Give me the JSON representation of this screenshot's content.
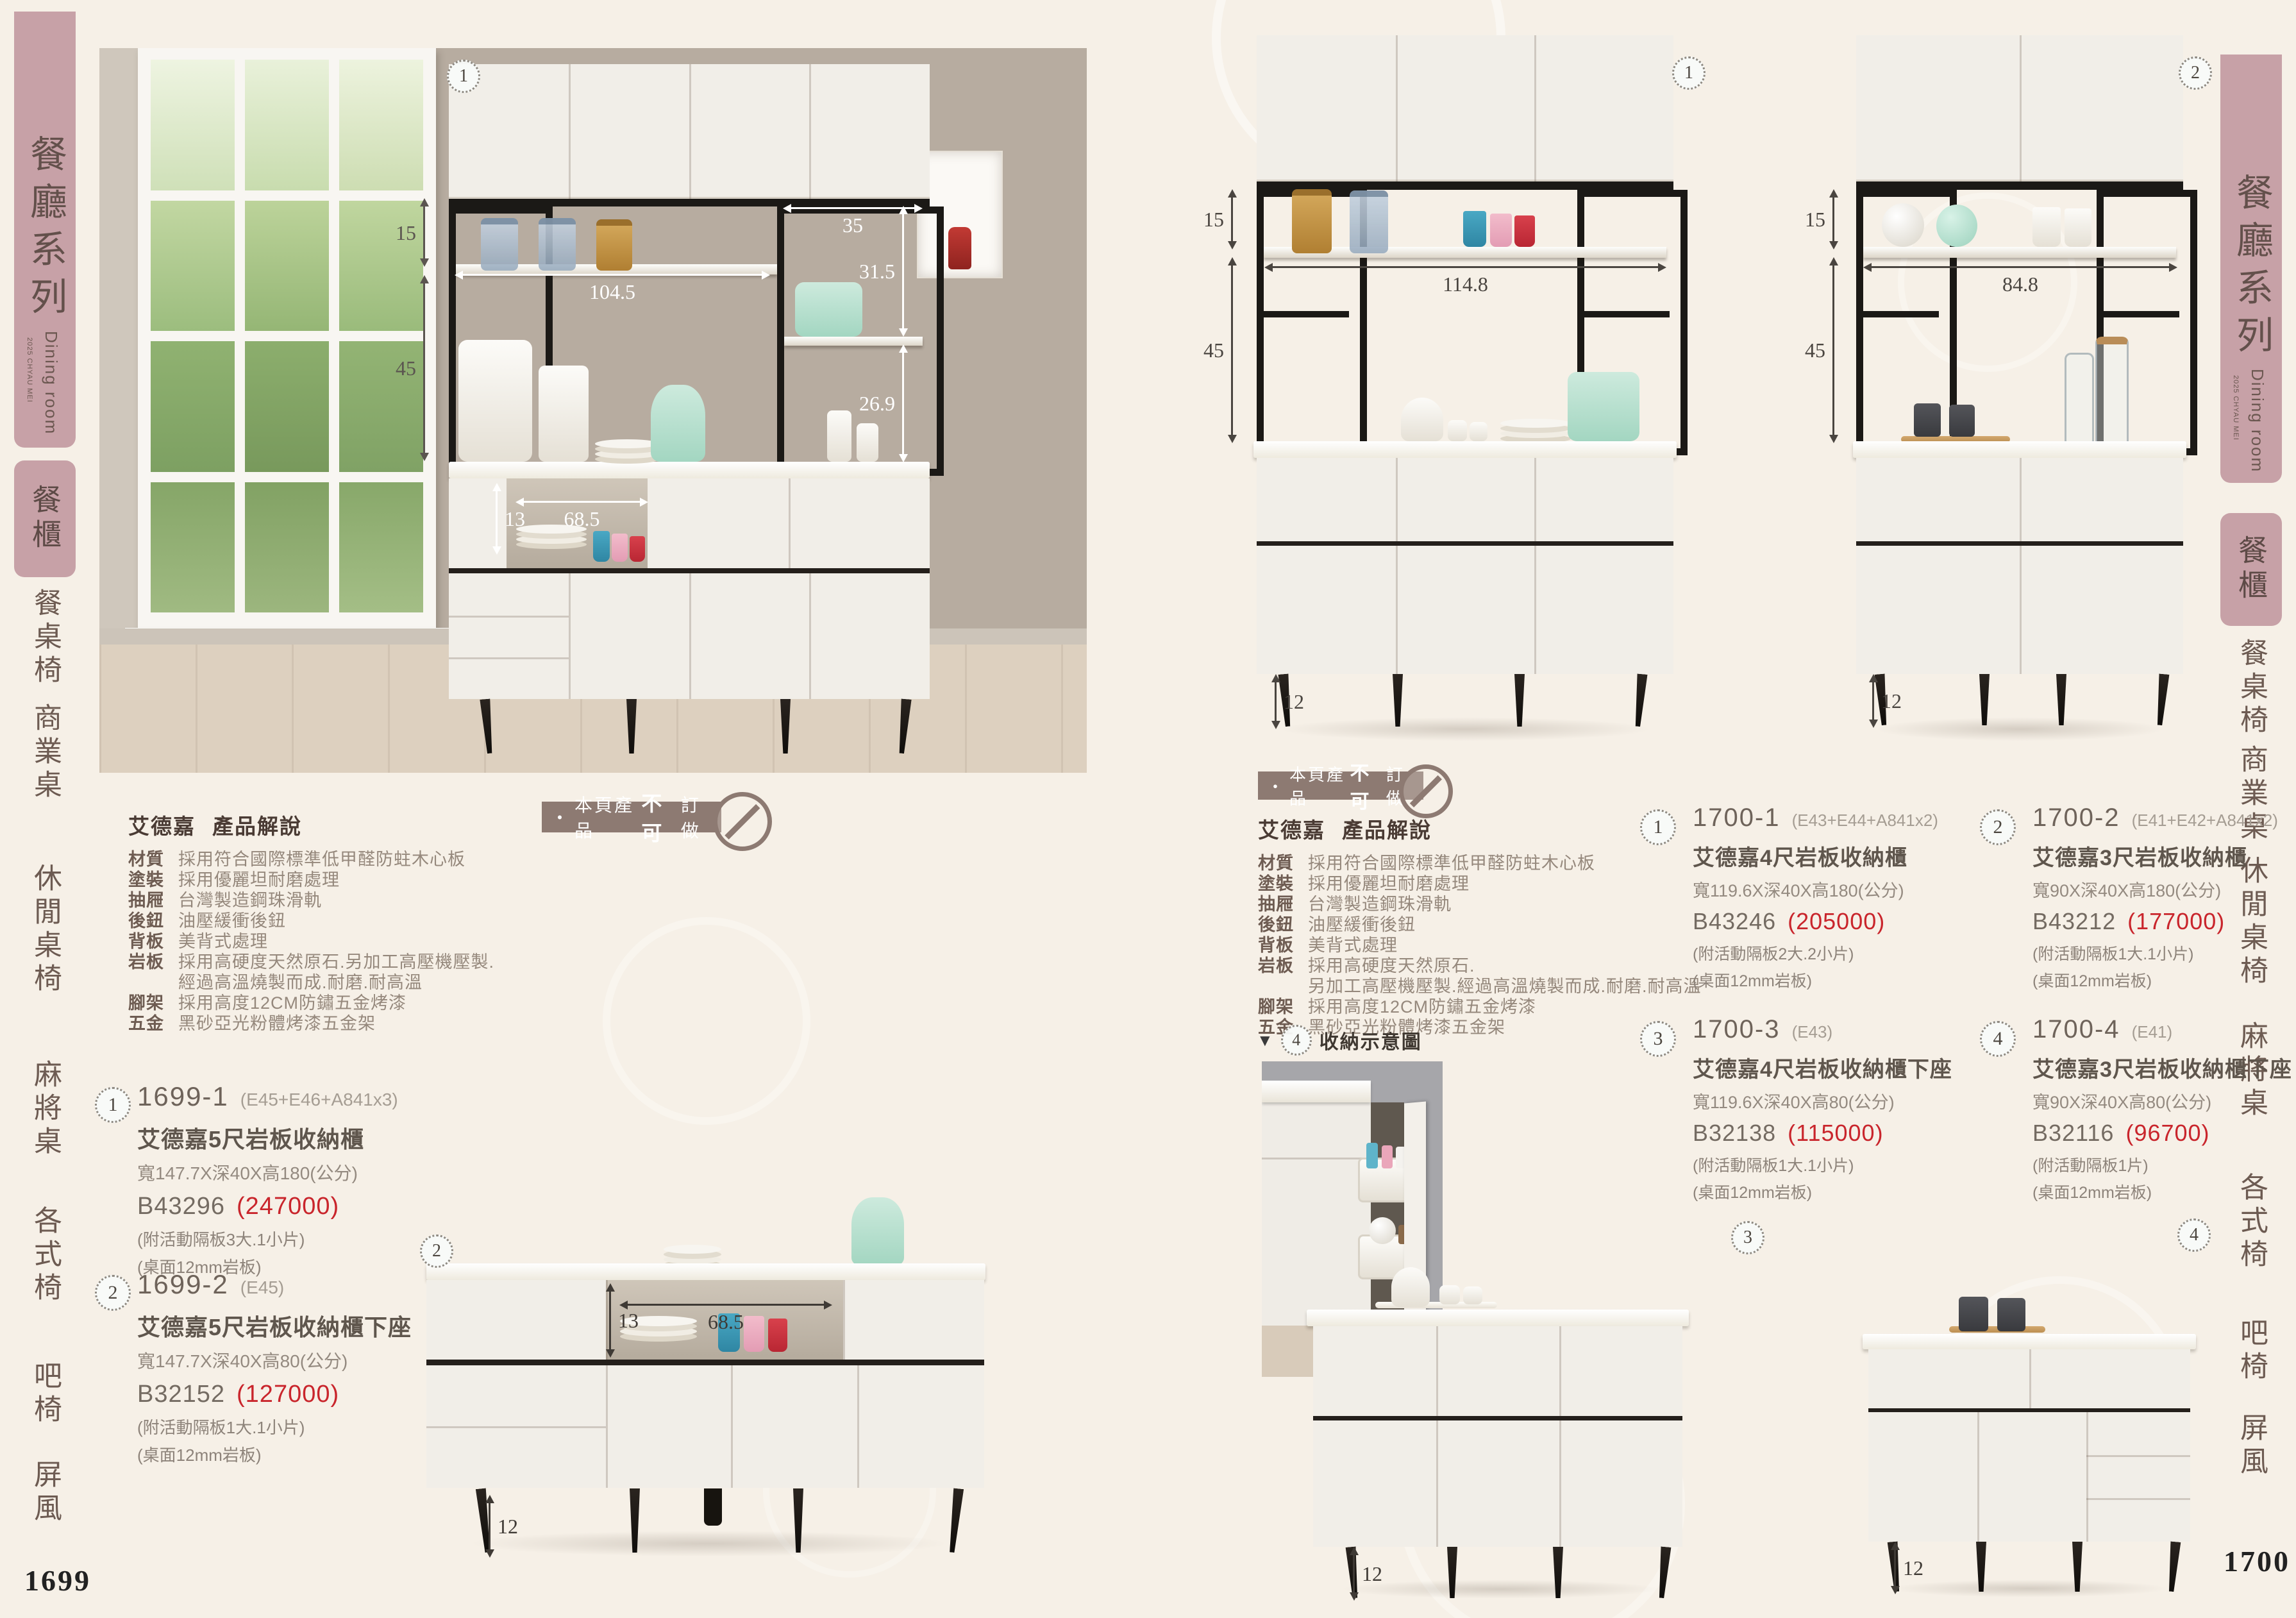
{
  "page": {
    "left_no": "1699",
    "right_no": "1700"
  },
  "sidebar": {
    "title": "餐廳系列",
    "en": "Dining room",
    "year": "2025 CHYAU MEI",
    "active": "餐櫃",
    "tabs": [
      "餐桌椅",
      "商業桌",
      "休閒桌椅",
      "麻將桌",
      "各式椅",
      "吧椅",
      "屏風"
    ]
  },
  "banner": {
    "dot": "・",
    "p1": "本頁產品",
    "bold": "不可",
    "p2": "訂做"
  },
  "brand": "艾德嘉",
  "spec_title": "產品解說",
  "spec_left": [
    {
      "k": "材質",
      "v": "採用符合國際標準低甲醛防蛀木心板"
    },
    {
      "k": "塗裝",
      "v": "採用優麗坦耐磨處理"
    },
    {
      "k": "抽屜",
      "v": "台灣製造鋼珠滑軌"
    },
    {
      "k": "後鈕",
      "v": "油壓緩衝後鈕"
    },
    {
      "k": "背板",
      "v": "美背式處理"
    },
    {
      "k": "岩板",
      "v": "採用高硬度天然原石.另加工高壓機壓製."
    },
    {
      "k": "",
      "v": "經過高溫燒製而成.耐磨.耐高溫"
    },
    {
      "k": "腳架",
      "v": "採用高度12CM防鏽五金烤漆"
    },
    {
      "k": "五金",
      "v": "黑砂亞光粉體烤漆五金架"
    }
  ],
  "spec_right": [
    {
      "k": "材質",
      "v": "採用符合國際標準低甲醛防蛀木心板"
    },
    {
      "k": "塗裝",
      "v": "採用優麗坦耐磨處理"
    },
    {
      "k": "抽屜",
      "v": "台灣製造鋼珠滑軌"
    },
    {
      "k": "後鈕",
      "v": "油壓緩衝後鈕"
    },
    {
      "k": "背板",
      "v": "美背式處理"
    },
    {
      "k": "岩板",
      "v": "採用高硬度天然原石."
    },
    {
      "k": "",
      "v": "另加工高壓機壓製.經過高溫燒製而成.耐磨.耐高溫"
    },
    {
      "k": "腳架",
      "v": "採用高度12CM防鏽五金烤漆"
    },
    {
      "k": "五金",
      "v": "黑砂亞光粉體烤漆五金架"
    }
  ],
  "products": {
    "p16991": {
      "badge": "1",
      "model": "1699-1",
      "combo": "(E45+E46+A841x3)",
      "name": "艾德嘉5尺岩板收納櫃",
      "size": "寬147.7X深40X高180(公分)",
      "code": "B43296",
      "price": "(247000)",
      "note1": "(附活動隔板3大.1小片)",
      "note2": "(桌面12mm岩板)"
    },
    "p16992": {
      "badge": "2",
      "model": "1699-2",
      "combo": "(E45)",
      "name": "艾德嘉5尺岩板收納櫃下座",
      "size": "寬147.7X深40X高80(公分)",
      "code": "B32152",
      "price": "(127000)",
      "note1": "(附活動隔板1大.1小片)",
      "note2": "(桌面12mm岩板)"
    },
    "p17001": {
      "badge": "1",
      "model": "1700-1",
      "combo": "(E43+E44+A841x2)",
      "name": "艾德嘉4尺岩板收納櫃",
      "size": "寬119.6X深40X高180(公分)",
      "code": "B43246",
      "price": "(205000)",
      "note1": "(附活動隔板2大.2小片)",
      "note2": "(桌面12mm岩板)"
    },
    "p17002": {
      "badge": "2",
      "model": "1700-2",
      "combo": "(E41+E42+A841x2)",
      "name": "艾德嘉3尺岩板收納櫃",
      "size": "寬90X深40X高180(公分)",
      "code": "B43212",
      "price": "(177000)",
      "note1": "(附活動隔板1大.1小片)",
      "note2": "(桌面12mm岩板)"
    },
    "p17003": {
      "badge": "3",
      "model": "1700-3",
      "combo": "(E43)",
      "name": "艾德嘉4尺岩板收納櫃下座",
      "size": "寬119.6X深40X高80(公分)",
      "code": "B32138",
      "price": "(115000)",
      "note1": "(附活動隔板1大.1小片)",
      "note2": "(桌面12mm岩板)"
    },
    "p17004": {
      "badge": "4",
      "model": "1700-4",
      "combo": "(E41)",
      "name": "艾德嘉3尺岩板收納櫃下座",
      "size": "寬90X深40X高80(公分)",
      "code": "B32116",
      "price": "(96700)",
      "note1": "(附活動隔板1片)",
      "note2": "(桌面12mm岩板)"
    }
  },
  "storage": {
    "marker": "▼",
    "badge": "4",
    "label": "收納示意圖"
  },
  "dims": {
    "lm": {
      "d15": "15",
      "d45": "45",
      "d104": "104.5",
      "d35": "35",
      "d315": "31.5",
      "d269": "26.9",
      "d13": "13",
      "d685": "68.5"
    },
    "lb": {
      "d13": "13",
      "d685": "68.5",
      "d12": "12"
    },
    "ra": {
      "d15": "15",
      "d45": "45",
      "d1148": "114.8",
      "d12": "12"
    },
    "rb": {
      "d15": "15",
      "d848": "84.8",
      "d45": "45",
      "d12": "12"
    },
    "rc": {
      "d12": "12"
    },
    "rd": {
      "d12": "12"
    }
  },
  "photo_badges": {
    "lm": "1",
    "lb": "2",
    "ra": "1",
    "rb": "2",
    "rc": "3",
    "rd": "4"
  },
  "colors": {
    "accent_pink": "#c7a1a7",
    "price_red": "#c9252c",
    "stamp_taupe": "#8d7a72",
    "bg_cream": "#f6f0e7"
  }
}
